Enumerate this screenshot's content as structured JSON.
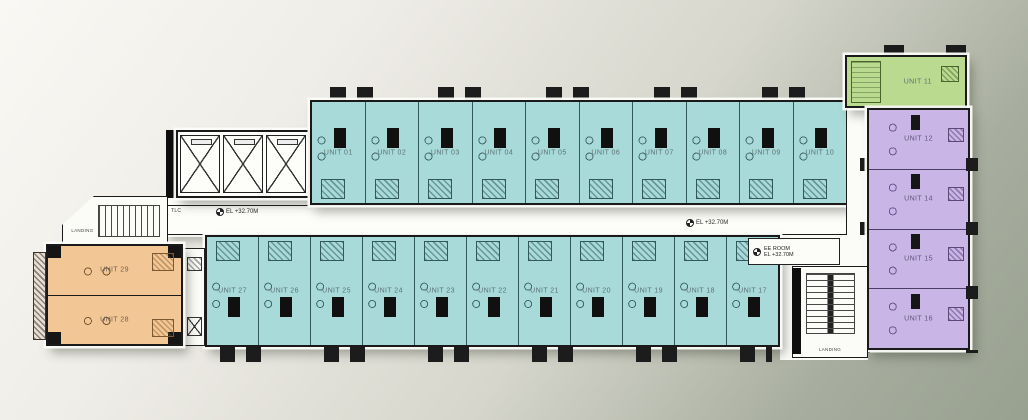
{
  "drawing": {
    "corridor_level_left": "EL +32.70M",
    "corridor_level_right": "EL +32.70M",
    "ee_room_name": "EE ROOM",
    "ee_room_level": "EL +32.70M",
    "stair_left_label": "LANDING",
    "stair_right_label": "LANDING",
    "closet_label": "TLC"
  },
  "units": {
    "top": [
      "UNIT 01",
      "UNIT 02",
      "UNIT 03",
      "UNIT 04",
      "UNIT 05",
      "UNIT 06",
      "UNIT 07",
      "UNIT 08",
      "UNIT 09",
      "UNIT 10"
    ],
    "bottom": [
      "UNIT 27",
      "UNIT 26",
      "UNIT 25",
      "UNIT 24",
      "UNIT 23",
      "UNIT 22",
      "UNIT 21",
      "UNIT 20",
      "UNIT 19",
      "UNIT 18",
      "UNIT 17"
    ],
    "left": [
      "UNIT 29",
      "UNIT 28"
    ],
    "green": "UNIT 11",
    "purple": [
      "UNIT 12",
      "UNIT 14",
      "UNIT 15",
      "UNIT 16"
    ]
  },
  "colors": {
    "studio_fill": "#a7dad8",
    "corner_fill": "#f3c795",
    "penthouse_fill": "#bada90",
    "east_fill": "#c9b6e6",
    "wall": "#1a1a1a",
    "label_text": "#5e7176",
    "background_light": "#faf8f4",
    "background_dark": "#98a090"
  }
}
